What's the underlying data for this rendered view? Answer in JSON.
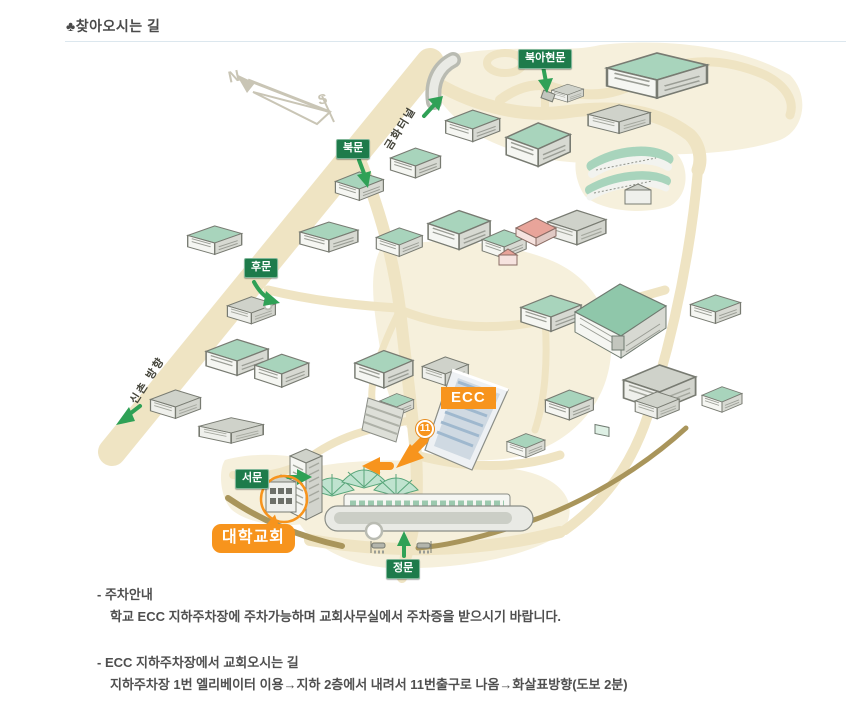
{
  "page": {
    "title_icon": "♣",
    "title": "찾아오시는 길"
  },
  "map": {
    "gates": {
      "bukahyeon": "북아현문",
      "north": "북문",
      "back": "후문",
      "west": "서문",
      "main": "정문"
    },
    "roads": {
      "geumhwa_tunnel": "금화터널",
      "sinchon": "신촌 방향"
    },
    "markers": {
      "ecc": "ECC",
      "exit_no": "11",
      "church": "대학교회"
    },
    "compass": {
      "north": "N",
      "south": "S"
    },
    "colors": {
      "gate_green": "#1e7b4b",
      "arrow_green": "#2fa156",
      "route_orange": "#f7941d",
      "road_cream": "#efe4c3",
      "terrain_cream": "#f6f0dc",
      "boundary_khaki": "#a9955b"
    }
  },
  "notes": {
    "parking_title": "- 주차안내",
    "parking_body": "학교 ECC 지하주차장에 주차가능하며 교회사무실에서 주차증을 받으시기 바랍니다.",
    "route_title": "- ECC 지하주차장에서 교회오시는 길",
    "route_body": "지하주차장 1번 엘리베이터 이용→지하 2층에서 내려서 11번출구로 나옴→화살표방향(도보 2분)"
  }
}
